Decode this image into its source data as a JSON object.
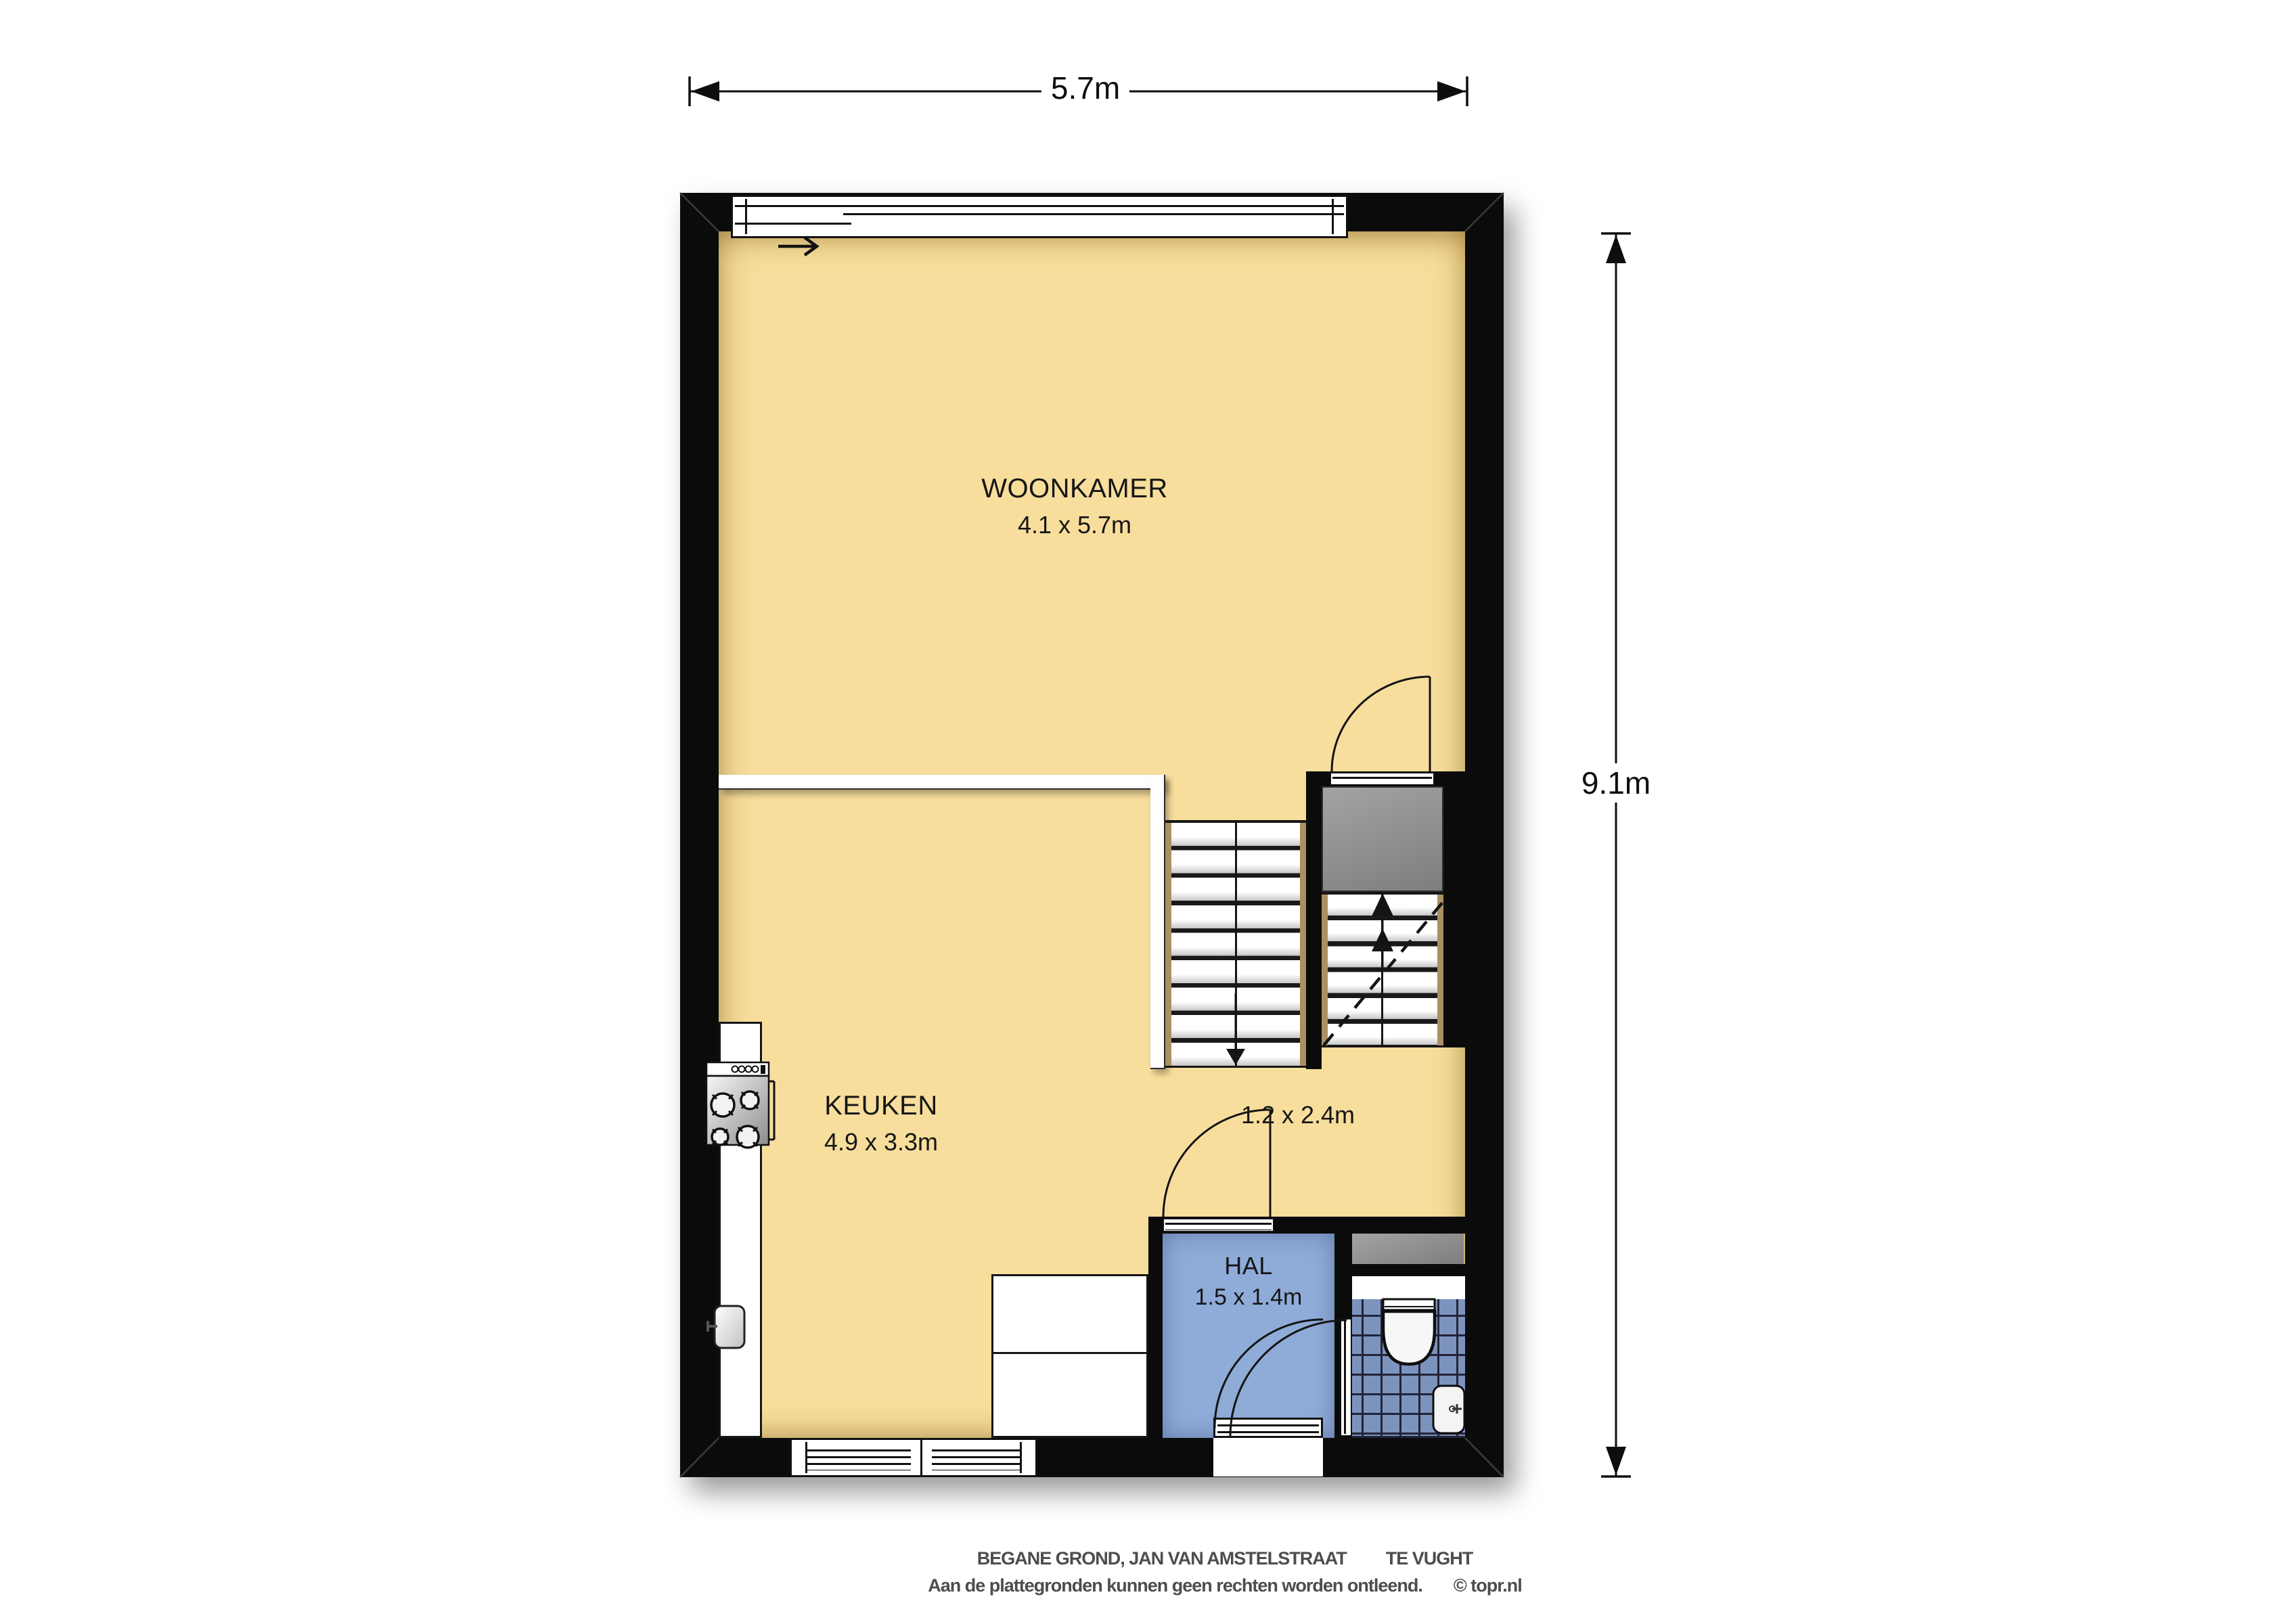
{
  "plan": {
    "floor_title": "BEGANE GROND",
    "dimensions": {
      "width_label": "5.7m",
      "height_label": "9.1m"
    },
    "rooms": {
      "woonkamer": {
        "name": "WOONKAMER",
        "size": "4.1 x 5.7m"
      },
      "keuken": {
        "name": "KEUKEN",
        "size": "4.9 x 3.3m"
      },
      "hal": {
        "name": "HAL",
        "size": "1.5 x 1.4m"
      },
      "stair_nook": {
        "size": "1.2 x 2.4m"
      }
    },
    "fixtures": [
      "stove-icon",
      "kitchen-sink-icon",
      "toilet-icon",
      "washbasin-icon",
      "staircase-down",
      "staircase-up",
      "door-swing-arc",
      "sliding-window-arrow"
    ]
  },
  "footer": {
    "line1_left": "BEGANE GROND, JAN VAN AMSTELSTRAAT",
    "line1_right": "TE VUGHT",
    "line2_left": "Aan de plattegronden kunnen geen rechten worden ontleend.",
    "line2_right": "© topr.nl"
  },
  "colors": {
    "wall": "#0b0b0b",
    "outline": "#111111",
    "floor": "#f8de9c",
    "hal": "#8facd8",
    "tile": "#7c93be",
    "tile_grid": "#23233a",
    "landing": "#8f8f8f",
    "stringer": "#ac8f63",
    "text_gray": "#4d4d4d"
  }
}
